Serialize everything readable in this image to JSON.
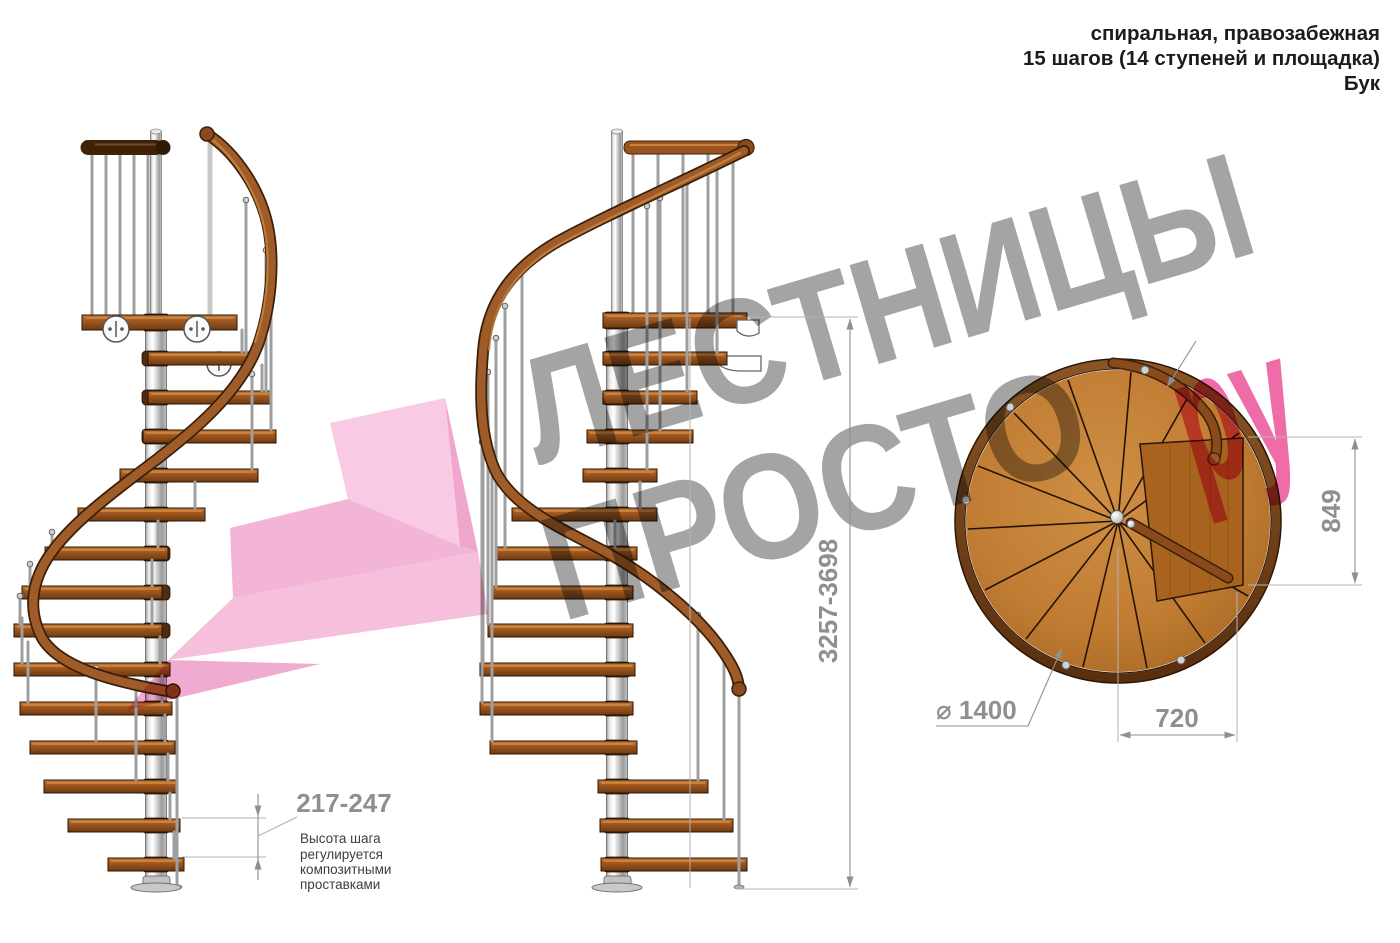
{
  "header": {
    "line1": "спиральная, правозабежная",
    "line2": "15 шагов (14 ступеней и площадка)",
    "line3": "Бук"
  },
  "watermark": {
    "word1": "ЛЕСТНИЦЫ",
    "word2": "ПРОСТО",
    "suffix": "ру"
  },
  "dimensions": {
    "step_height": "217-247",
    "step_height_note": [
      "Высота шага",
      "регулируется",
      "композитными",
      "проставками"
    ],
    "total_height": "3257-3698",
    "landing_side": "849",
    "landing_width": "720",
    "diameter": "⌀ 1400"
  },
  "colors": {
    "accent_pink": "#ee6da8",
    "arrow_pink": "#f2add3",
    "watermark_gray": "#a4a4a4",
    "wood": "#a85c22",
    "dimension_gray": "#8f8f8f"
  }
}
